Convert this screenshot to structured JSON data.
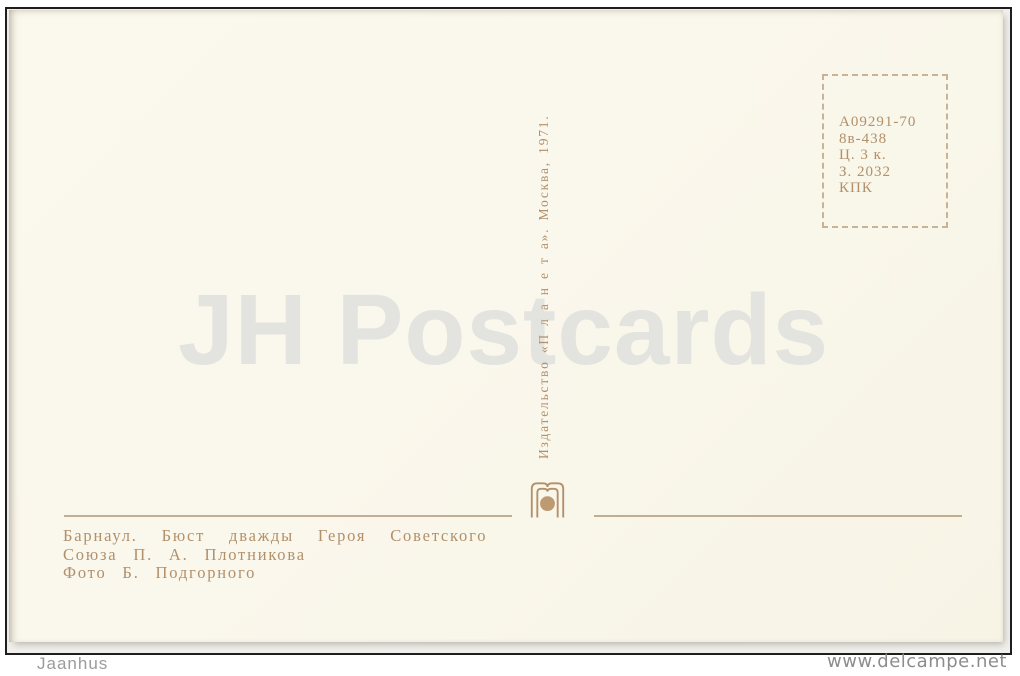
{
  "overlay": {
    "seller_watermark": "JH Postcards",
    "corner_watermark": "Jaanhus",
    "site_watermark": "www.delcampe.net"
  },
  "postcard": {
    "publisher_imprint": "Издательство «П л а н е т а». Москва, 1971.",
    "print_code_box": {
      "lines": [
        "А09291-70",
        "8в-438",
        "Ц. 3 к.",
        "З. 2032",
        "КПК"
      ]
    },
    "caption": {
      "lines": [
        "Барнаул. Бюст дважды Героя Советского",
        "Союза П. А. Плотникова",
        "Фото Б. Подгорного"
      ]
    },
    "logo": "planeta-publisher-logo"
  },
  "colors": {
    "card-bg": "#faf7ec",
    "ink": "#b2906a",
    "ink-soft": "#b7a183",
    "dash": "#c9b394",
    "watermark": "#e3e3df",
    "scan-bg": "#f1f0ec",
    "frame": "#1e1e1e",
    "overlay-gray": "#9b9b9b",
    "site-gray": "#8d8d8d"
  }
}
